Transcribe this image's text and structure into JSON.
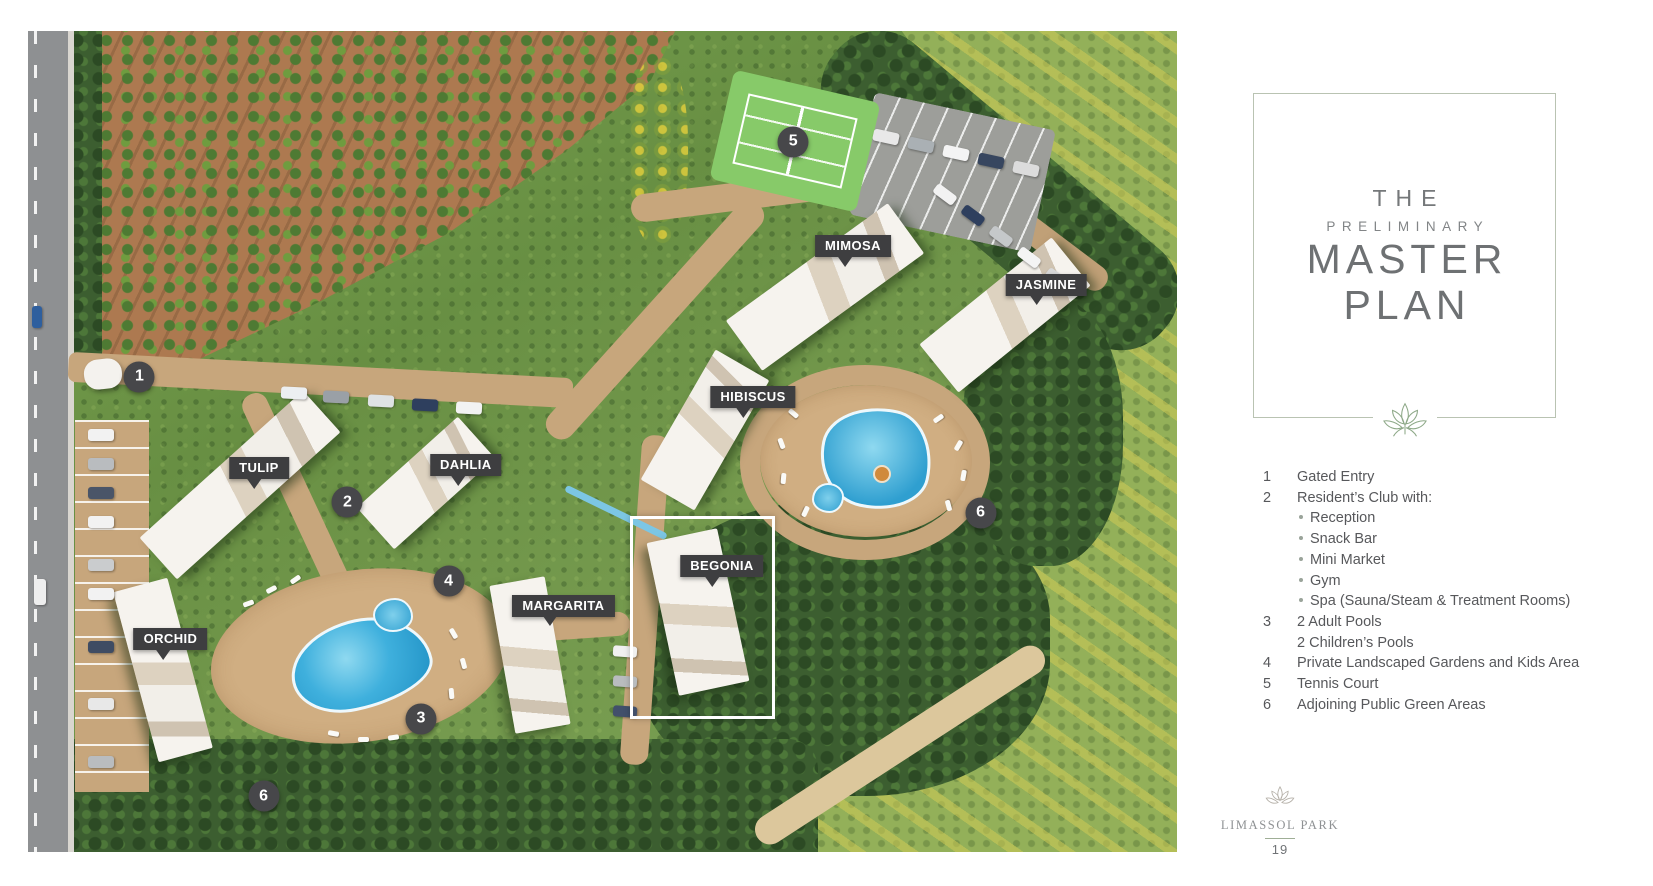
{
  "panel": {
    "title": [
      "THE",
      "PRELIMINARY",
      "MASTER",
      "PLAN"
    ],
    "legend": [
      {
        "num": "1",
        "lines": [
          "Gated Entry"
        ],
        "bullets": []
      },
      {
        "num": "2",
        "lines": [
          "Resident’s Club with:"
        ],
        "bullets": [
          "Reception",
          "Snack Bar",
          "Mini Market",
          "Gym",
          "Spa (Sauna/Steam & Treatment Rooms)"
        ]
      },
      {
        "num": "3",
        "lines": [
          "2 Adult Pools",
          "2 Children’s Pools"
        ],
        "bullets": []
      },
      {
        "num": "4",
        "lines": [
          "Private Landscaped Gardens and Kids Area"
        ],
        "bullets": []
      },
      {
        "num": "5",
        "lines": [
          "Tennis Court"
        ],
        "bullets": []
      },
      {
        "num": "6",
        "lines": [
          "Adjoining Public Green Areas"
        ],
        "bullets": []
      }
    ]
  },
  "map": {
    "building_labels": [
      {
        "text": "TULIP",
        "x": 20.1,
        "y": 53.2
      },
      {
        "text": "DAHLIA",
        "x": 38.1,
        "y": 52.9
      },
      {
        "text": "ORCHID",
        "x": 12.4,
        "y": 74.1
      },
      {
        "text": "MARGARITA",
        "x": 46.6,
        "y": 70.0
      },
      {
        "text": "BEGONIA",
        "x": 60.4,
        "y": 65.2
      },
      {
        "text": "HIBISCUS",
        "x": 63.1,
        "y": 44.6
      },
      {
        "text": "MIMOSA",
        "x": 71.8,
        "y": 26.2
      },
      {
        "text": "JASMINE",
        "x": 88.6,
        "y": 30.9
      }
    ],
    "markers": [
      {
        "n": "1",
        "x": 9.7,
        "y": 42.1
      },
      {
        "n": "2",
        "x": 27.8,
        "y": 57.4
      },
      {
        "n": "3",
        "x": 34.2,
        "y": 83.8
      },
      {
        "n": "4",
        "x": 36.6,
        "y": 67.0
      },
      {
        "n": "5",
        "x": 66.6,
        "y": 13.5
      },
      {
        "n": "6",
        "x": 82.9,
        "y": 58.7
      },
      {
        "n": "6",
        "x": 20.5,
        "y": 93.2
      }
    ],
    "highlight": {
      "label": "BEGONIA",
      "x": 52.4,
      "y": 59.1,
      "w": 12.1,
      "h": 24.0
    }
  },
  "footer": {
    "brand": "LIMASSOL PARK",
    "page_number": "19"
  },
  "colors": {
    "label_bg": "#3e3e40",
    "marker_bg": "#47474a",
    "highlight_border": "#ffffff",
    "title_text": "#6e7173",
    "box_border": "#b9c3b2",
    "leaf_green": "#8da887",
    "legend_text": "#57585b",
    "bullet_dot": "#9aa49a",
    "footer_text": "#8e9193"
  }
}
